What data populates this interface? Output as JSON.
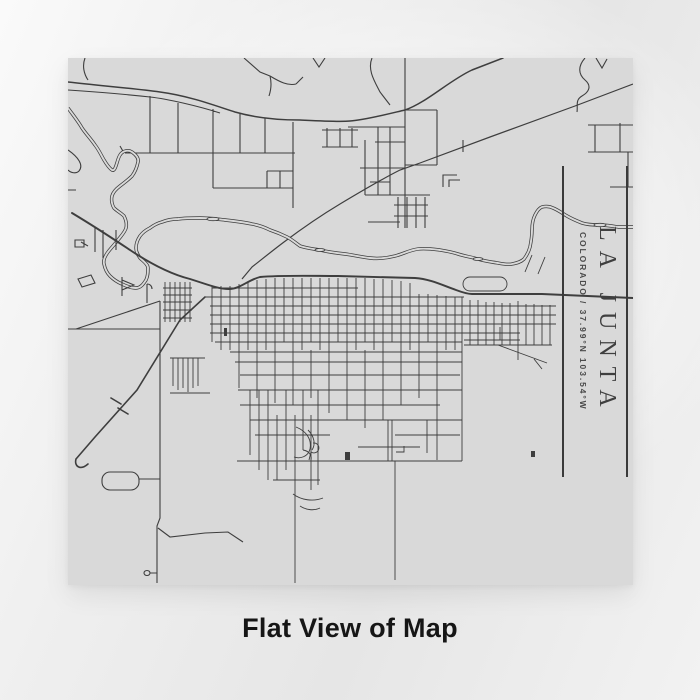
{
  "panel": {
    "title": "LA JUNTA",
    "subtitle": "COLORADO / 37.99°N 103.54°W"
  },
  "caption": "Flat View of Map",
  "map": {
    "style": "flat line-art street map",
    "features": [
      "street-grid",
      "river",
      "highway",
      "railroad",
      "pond-loop",
      "ballpark-loop"
    ]
  },
  "colors": {
    "backdrop": "#ececec",
    "map_background": "#d9d9d9",
    "road": "#3e3e3e",
    "river": "#3d3d3d",
    "panel_rule": "#3a3a3a",
    "title_text": "#3f3f3f",
    "subtitle_text": "#4a4a4a",
    "caption_text": "#161616"
  }
}
